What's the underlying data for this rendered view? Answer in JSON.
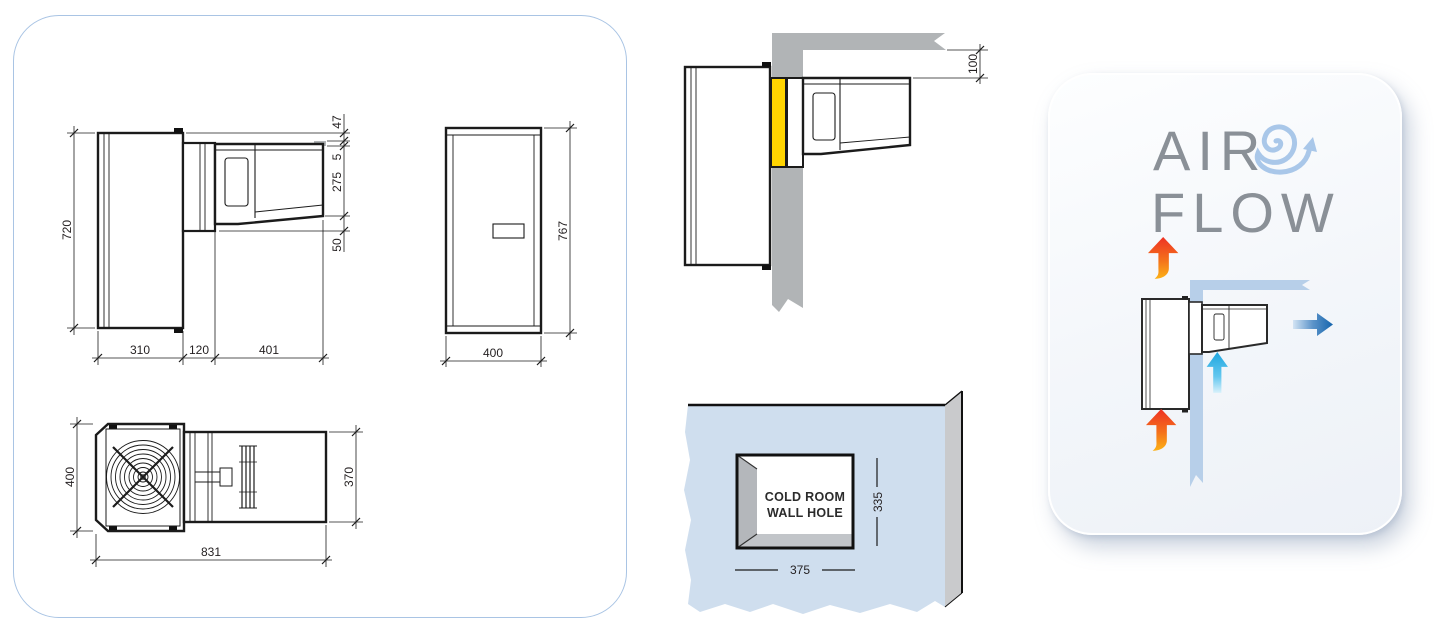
{
  "left_panel": {
    "side_view": {
      "height": "720",
      "top_gap": "47",
      "panel_gap": "5",
      "unit_height": "275",
      "bottom_gap": "50",
      "body_width": "310",
      "mid_width": "120",
      "unit_width": "401"
    },
    "front_view": {
      "height": "767",
      "width": "400"
    },
    "top_view": {
      "depth": "400",
      "unit_depth": "370",
      "length": "831"
    }
  },
  "wall_section": {
    "ceiling_clearance": "100"
  },
  "wall_hole": {
    "label_line1": "COLD ROOM",
    "label_line2": "WALL HOLE",
    "hole_height": "335",
    "hole_width": "375"
  },
  "airflow_panel": {
    "word1": "AIR",
    "word2": "FLOW"
  },
  "colors": {
    "panel_border": "#a9c4e4",
    "line_black": "#1b1b1b",
    "wall_gray": "#b1b4b6",
    "insulation_yellow": "#ffd400",
    "coldroom_wall_blue": "#cfdeee",
    "coldroom_wall_side_gray": "#c9cacc",
    "hole_bevel_gray": "#b4b7bb",
    "flow_wall_blue": "#b7cfe9",
    "hot_air_red": "#ee3124",
    "hot_air_orange": "#fcb216",
    "cold_air_cyan": "#1fa6df",
    "exhaust_blue": "#1565ad",
    "title_gray": "#8a9097",
    "spiral_blue": "#a9c7e9"
  }
}
